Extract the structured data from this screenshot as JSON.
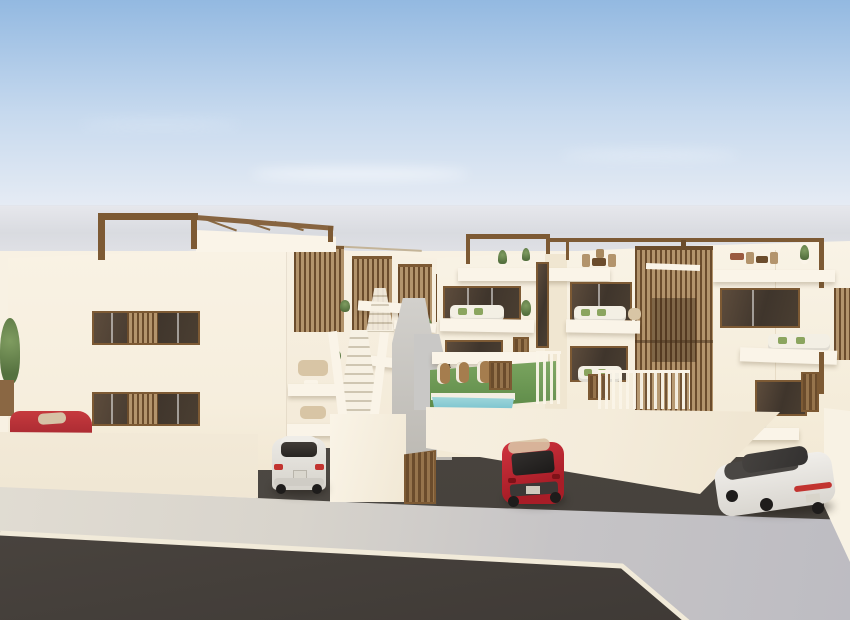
{
  "meta": {
    "description": "3D architectural rendering of a modern white residential complex with rooftop pergolas, timber slat screens, a small pool garden and three cars parked along the street",
    "style": "photorealistic daytime exterior render, no visible text"
  },
  "palette": {
    "sky-top": "#93b9e1",
    "sky-mid": "#c6d9ee",
    "sky-low": "#eaeef5",
    "sea": "#d9dbe0",
    "facade": "#f8f1e3",
    "facade-shade": "#f0e6d1",
    "white-trim": "#faf4e8",
    "wood": "#7d5a34",
    "wood-light": "#b3946c",
    "wood-dark": "#6b4c2c",
    "glass-dark": "#3f352c",
    "glass-mid": "#5d4c3c",
    "grass-light": "#7aa45f",
    "grass-dark": "#5d8a48",
    "pool-light": "#9fd6da",
    "pool-dark": "#6fbecb",
    "asphalt": "#514b45",
    "asphalt-dark": "#3e3935",
    "sidewalk-warm": "#e3ded4",
    "sidewalk-cool": "#bdbcc2",
    "concrete": "#c9c8c6",
    "curb": "#f1ead9",
    "car-red": "#bf2430",
    "car-white": "#e7e5e0",
    "tail-red": "#c23430",
    "tire": "#1e1c1b",
    "cushion-green": "#8ba55f",
    "tan": "#d8c5a5",
    "slope-grey": "#c2c2c7"
  },
  "scene": {
    "labels": {
      "sky": "Blue gradient sky with faint clouds",
      "sea": "Hazy pale horizon band",
      "slope": "Distant grey slope at right edge",
      "road": "Dark asphalt street",
      "sidewalk": "Light concrete sidewalk and driveway apron",
      "curb": "White painted curb line",
      "left_building": "Left white apartment block",
      "left_pergola": "Timber rooftop pergola",
      "window_upper": "Upper slatted window",
      "window_lower": "Lower slatted window",
      "left_wall": "White boundary wall (left plot)",
      "hidden_car": "Red car roof behind wall",
      "tree": "Potted tree at left edge",
      "townhouses": "Receding terraced townhouse row",
      "stairs": "Central white exterior staircase",
      "garage": "Timber garage door",
      "sedan": "White sedan parked in driveway",
      "right_building": "Right white apartment block",
      "slat_tower": "Vertical timber slat stair tower",
      "garden": "Front garden with loungers",
      "pool": "Turquoise plunge pool",
      "fence": "White picket fence",
      "right_wall": "White boundary wall (right plot)",
      "far_wall": "Far-right boundary wall",
      "hatchback": "Red hatchback parked in forecourt",
      "suv": "White SUV parked in side drive",
      "dark_car": "Dark car parked beyond right wall"
    }
  }
}
